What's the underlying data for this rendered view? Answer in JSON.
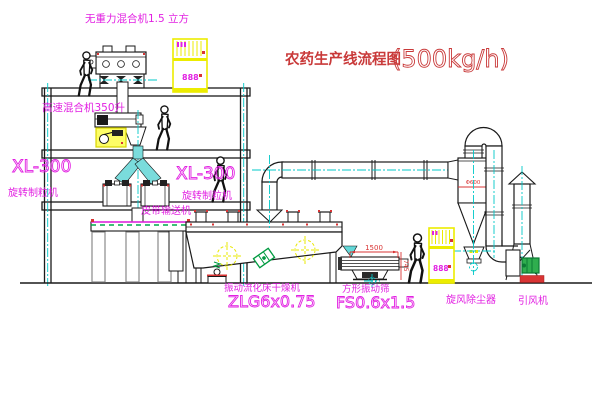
{
  "title": {
    "cn": "农药生产线流程图",
    "capacity": "(500kg/h)"
  },
  "labels": {
    "gravity_mixer": "无重力混合机1.5 立方",
    "high_speed_mixer": "高速混合机350升",
    "granulator_left_model": "XL-300",
    "granulator_left_name": "旋转制粒机",
    "granulator_right_model": "XL-300",
    "granulator_right_name": "旋转制粒机",
    "belt_conveyor": "皮带输送机",
    "dryer_name": "振动流化床干燥机",
    "dryer_model": "ZLG6x0.75",
    "sieve_name": "方形振动筛",
    "sieve_model": "FS0.6x1.5",
    "cyclone": "旋风除尘器",
    "fan": "引风机"
  },
  "dimensions": {
    "sieve_length": "1500",
    "sieve_height": "745",
    "cyclone_diameter": "Φ600"
  },
  "displays": {
    "cabinet1": "888",
    "cabinet2": "888"
  },
  "colors": {
    "label_magenta": "#e221e2",
    "title_red": "#c93a3a",
    "cabinet_yellow": "#ecec00",
    "centerline_cyan": "#00c8c8",
    "chute_cyan": "#7adcdc",
    "motor_green": "#2fae4e",
    "mark_red": "#d93434"
  }
}
